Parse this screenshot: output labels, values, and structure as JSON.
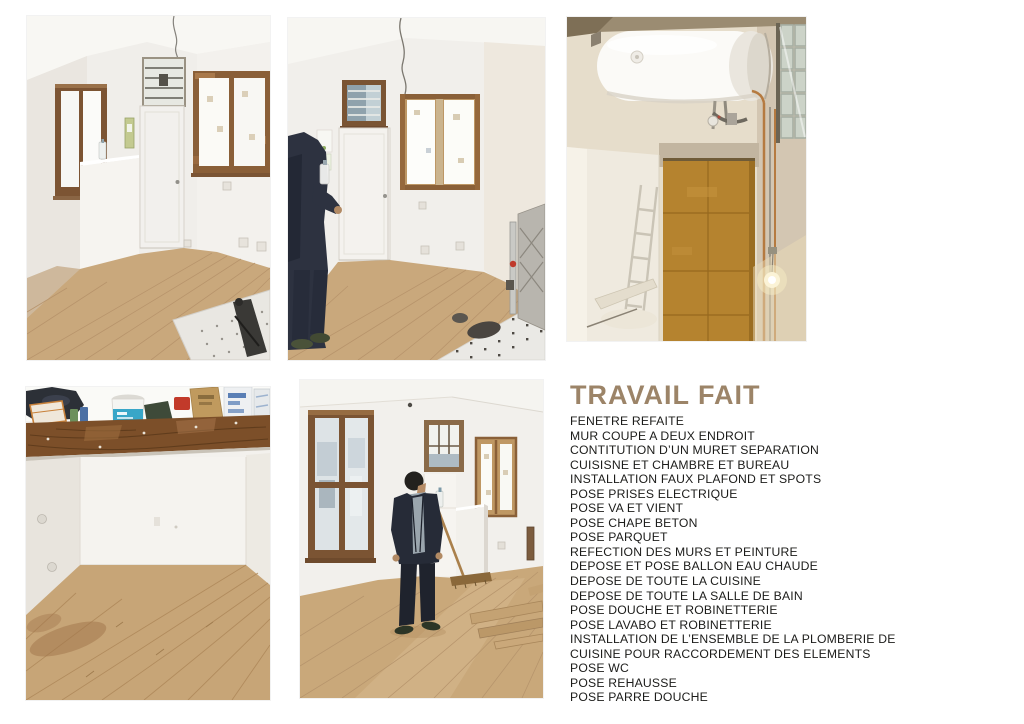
{
  "page": {
    "background": "#ffffff",
    "width": 1024,
    "height": 724
  },
  "photos": [
    {
      "name": "photo-renovated-room-door-windows"
    },
    {
      "name": "photo-renovated-room-person-standing"
    },
    {
      "name": "photo-water-heater-installation"
    },
    {
      "name": "photo-mezzanine-beam-storage"
    },
    {
      "name": "photo-room-person-broom-parquet"
    }
  ],
  "work_done": {
    "title": "TRAVAIL FAIT",
    "title_color": "#9c8468",
    "text_color": "#1c1c1a",
    "items": [
      "FENETRE REFAITE",
      "MUR COUPE A DEUX ENDROIT",
      "CONTITUTION D’UN MURET SEPARATION",
      "CUISISNE ET CHAMBRE ET BUREAU",
      "INSTALLATION FAUX PLAFOND ET SPOTS",
      "POSE PRISES ELECTRIQUE",
      "POSE VA ET VIENT",
      "POSE CHAPE BETON",
      "POSE PARQUET",
      "REFECTION DES MURS ET PEINTURE",
      "DEPOSE ET POSE BALLON EAU CHAUDE",
      "DEPOSE DE TOUTE LA CUISINE",
      "DEPOSE DE TOUTE LA SALLE DE BAIN",
      "POSE DOUCHE ET ROBINETTERIE",
      "POSE LAVABO ET ROBINETTERIE",
      "INSTALLATION DE L’ENSEMBLE DE LA PLOMBERIE DE",
      "CUISINE POUR RACCORDEMENT DES ELEMENTS",
      "POSE WC",
      "POSE REHAUSSE",
      "POSE PARRE DOUCHE"
    ]
  },
  "palette": {
    "parquet": "#c9a87c",
    "wall": "#f2f0ec",
    "wood_frame": "#7b5433",
    "gold_panel": "#b5832f"
  }
}
